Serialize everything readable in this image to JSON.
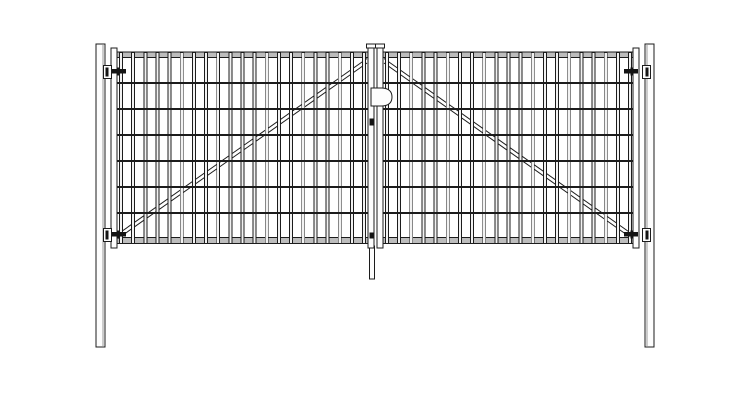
{
  "title": "double-leaf-mesh-gate-technical-drawing",
  "colors": {
    "background": "#ffffff",
    "line": "#1c1c1c",
    "rail_fill": "#bdbdbd",
    "wire_core": "#f2f2f2",
    "metal_fill": "#fdfdfd",
    "hinge_dark": "#141414",
    "post_shade": "#9a9a9a"
  },
  "canvas": {
    "width": 750,
    "height": 400
  },
  "drawing": {
    "posts": [
      {
        "name": "left-post",
        "x": 96,
        "y": 44,
        "w": 9,
        "h": 303,
        "shade_x": 103
      },
      {
        "name": "right-post",
        "x": 645,
        "y": 44,
        "w": 9,
        "h": 303,
        "shade_x": 647
      }
    ],
    "rail": {
      "top_y": 52,
      "top_h": 5.5,
      "bot_y": 237.5,
      "bot_h": 6
    },
    "mesh": {
      "wire_w": 3,
      "wire_top": 52.5,
      "wire_bottom": 243.5,
      "wire_count": 21,
      "h_wire_ys": [
        83,
        109,
        135,
        161,
        187,
        213
      ],
      "h_wire_t": 2
    },
    "leaves": [
      {
        "name": "left-leaf",
        "x0": 117,
        "x1": 368,
        "wire_first": 119.5,
        "wire_last": 362.5,
        "diag": {
          "x1": 118,
          "y1": 234,
          "x2": 367,
          "y2": 58.5,
          "offset": 4.5
        },
        "outer_stile": {
          "x": 111,
          "y": 48,
          "w": 6,
          "h": 200
        },
        "center_stile": {
          "x": 368,
          "y": 45,
          "w": 6,
          "h": 203,
          "cap_x": 366.5,
          "cap_y": 44,
          "cap_w": 9,
          "cap_h": 4
        }
      },
      {
        "name": "right-leaf",
        "x0": 383,
        "x1": 633,
        "wire_first": 385.5,
        "wire_last": 628.5,
        "diag": {
          "x1": 632,
          "y1": 234,
          "x2": 384,
          "y2": 58.5,
          "offset": 4.5
        },
        "outer_stile": {
          "x": 633,
          "y": 48,
          "w": 6,
          "h": 200
        },
        "center_stile": {
          "x": 377,
          "y": 45,
          "w": 6,
          "h": 203,
          "cap_x": 375.5,
          "cap_y": 44,
          "cap_w": 9,
          "cap_h": 4
        }
      }
    ],
    "hinges": [
      {
        "name": "hinge-top-left",
        "side": "left",
        "bracket_x": 103.5,
        "y": 65.5,
        "bolt_x": 112,
        "tab_x": 117
      },
      {
        "name": "hinge-bottom-left",
        "side": "left",
        "bracket_x": 103.5,
        "y": 228.5,
        "bolt_x": 112,
        "tab_x": 117
      },
      {
        "name": "hinge-top-right",
        "side": "right",
        "bracket_x": 642.5,
        "y": 65.5,
        "bolt_x": 624,
        "tab_x": 630.5
      },
      {
        "name": "hinge-bottom-right",
        "side": "right",
        "bracket_x": 642.5,
        "y": 228.5,
        "bolt_x": 624,
        "tab_x": 630.5
      }
    ],
    "hinge_shape": {
      "bracket_w": 8,
      "bracket_h": 13,
      "inner_w": 3,
      "inner_h": 9,
      "inner_dy": 2,
      "inner_dx_left": 2,
      "inner_dx_right": 3,
      "bolt_w": 14,
      "bolt_h": 4.5,
      "bolt_dy": 3.5,
      "tab_w": 2.5,
      "tab_h": 8,
      "tab_dy": 2
    },
    "latch": {
      "x": 371,
      "y": 88,
      "w": 21,
      "h": 18
    },
    "knobs": [
      {
        "x": 369.5,
        "y": 118.5,
        "w": 4,
        "h": 7
      },
      {
        "x": 369.5,
        "y": 232.5,
        "w": 4,
        "h": 6
      }
    ],
    "drop_rod": {
      "x": 369.5,
      "y": 246,
      "w": 5,
      "h": 33
    }
  }
}
